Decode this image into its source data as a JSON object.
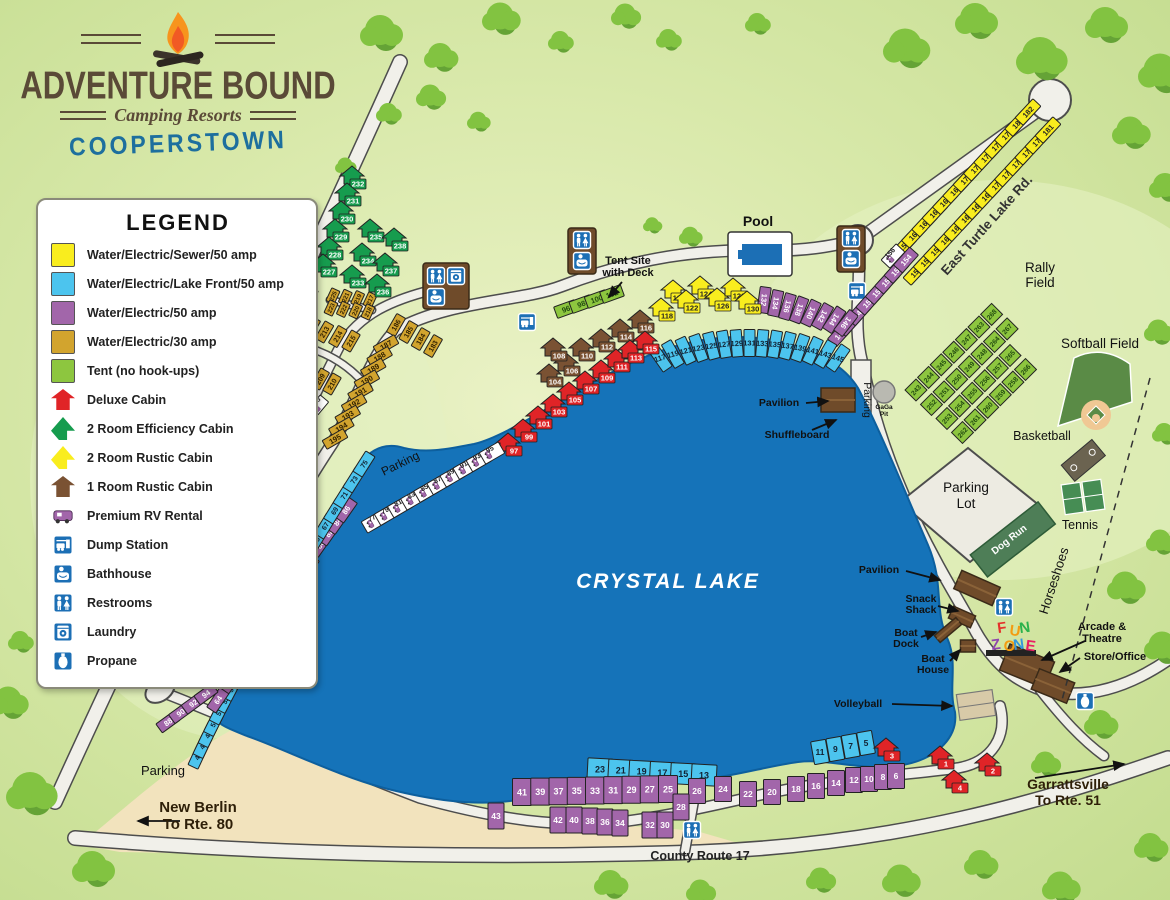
{
  "logo": {
    "name": "ADVENTURE BOUND",
    "tagline": "Camping Resorts",
    "location": "COOPERSTOWN"
  },
  "legend": {
    "title": "LEGEND",
    "items": [
      {
        "type": "yellow",
        "label": "Water/Electric/Sewer/50 amp"
      },
      {
        "type": "blue",
        "label": "Water/Electric/Lake Front/50 amp"
      },
      {
        "type": "purple",
        "label": "Water/Electric/50 amp"
      },
      {
        "type": "gold",
        "label": "Water/Electric/30 amp"
      },
      {
        "type": "tent",
        "label": "Tent (no hook-ups)"
      },
      {
        "type": "cabin-red",
        "label": "Deluxe Cabin"
      },
      {
        "type": "cabin-green",
        "label": "2 Room Efficiency Cabin"
      },
      {
        "type": "cabin-yellow",
        "label": "2 Room Rustic Cabin"
      },
      {
        "type": "cabin-brown",
        "label": "1 Room Rustic Cabin"
      },
      {
        "type": "rv",
        "label": "Premium RV Rental"
      },
      {
        "type": "dump",
        "label": "Dump Station"
      },
      {
        "type": "bath",
        "label": "Bathhouse"
      },
      {
        "type": "wc",
        "label": "Restrooms"
      },
      {
        "type": "laundry",
        "label": "Laundry"
      },
      {
        "type": "propane",
        "label": "Propane"
      }
    ]
  },
  "colors": {
    "yellow": "#f9ed1e",
    "blue": "#4cc4ee",
    "purple": "#a266aa",
    "gold": "#d2a42e",
    "tent": "#8dc63f",
    "cabin_red": "#e02427",
    "cabin_green": "#169c4e",
    "cabin_yellow": "#f9ed1e",
    "cabin_brown": "#7a5233",
    "rv_white": "#ffffff",
    "lake": "#1573b9",
    "road": "#f1f0ea",
    "icon_blue": "#1c6fb5",
    "beach": "#f2e3bd",
    "building": "#6f4b2a",
    "tree": "#82c341",
    "tree_dark": "#65a336"
  },
  "map": {
    "lake_name": "CRYSTAL LAKE",
    "labels": {
      "pool": "Pool",
      "tent_deck": [
        "Tent Site",
        "with Deck"
      ],
      "east_rd": "East Turtle Lake Rd.",
      "west_rd": "West Turtle Lake Rd.",
      "rally": [
        "Rally",
        "Field"
      ],
      "softball": "Softball Field",
      "basketball": "Basketball",
      "tennis": "Tennis",
      "horseshoes": "Horseshoes",
      "parking_lot": [
        "Parking",
        "Lot"
      ],
      "dog_run": "Dog Run",
      "gaga": [
        "GaGa",
        "Pit"
      ],
      "parking_sw": "Parking",
      "parking_w": "Parking",
      "parking_e": "Parking",
      "pavilion_n": "Pavilion",
      "shuffleboard": "Shuffleboard",
      "pavilion_s": "Pavilion",
      "snack": [
        "Snack",
        "Shack"
      ],
      "boat_dock": [
        "Boat",
        "Dock"
      ],
      "boat_house": [
        "Boat",
        "House"
      ],
      "volleyball": "Volleyball",
      "arcade": [
        "Arcade &",
        "Theatre"
      ],
      "store": "Store/Office",
      "county": "County Route 17",
      "new_berlin": [
        "New Berlin",
        "To Rte. 80"
      ],
      "garrattsville": [
        "Garrattsville",
        "To Rte. 51"
      ],
      "fun_zone": [
        "FUN",
        "ZONE"
      ]
    },
    "site_groups": [
      {
        "id": "ne_yellow_inner",
        "type": "yellow",
        "sites": [
          158,
          160,
          162,
          164,
          166,
          168,
          170,
          172,
          174,
          176,
          178,
          180,
          182
        ]
      },
      {
        "id": "ne_rv156",
        "type": "rv",
        "sites": [
          156
        ]
      },
      {
        "id": "ne_yellow_outer",
        "type": "yellow",
        "sites": [
          155,
          157,
          159,
          161,
          163,
          165,
          167,
          169,
          171,
          173,
          175,
          177,
          179,
          181
        ]
      },
      {
        "id": "ne_purple",
        "type": "purple",
        "sites": [
          147,
          148,
          149,
          150,
          151,
          152,
          153,
          154
        ]
      },
      {
        "id": "n_purple",
        "type": "purple",
        "sites": [
          132,
          134,
          136,
          138,
          140,
          142,
          144,
          146
        ]
      },
      {
        "id": "n_blue",
        "type": "blue",
        "sites": [
          117,
          119,
          121,
          123,
          125,
          127,
          129,
          131,
          133,
          135,
          137,
          139,
          141,
          143,
          145
        ]
      },
      {
        "id": "tent_deck_sites",
        "type": "tent",
        "sites": [
          96,
          98,
          100,
          102
        ]
      },
      {
        "id": "cabins_yellow",
        "type": "cabin-yellow",
        "sites": [
          118,
          120,
          122,
          124,
          126,
          128,
          130
        ]
      },
      {
        "id": "cabins_brown",
        "type": "cabin-brown",
        "sites": [
          104,
          106,
          108,
          110,
          112,
          114,
          116
        ]
      },
      {
        "id": "cabins_red_shore",
        "type": "cabin-red",
        "sites": [
          97,
          99,
          101,
          103,
          105,
          107,
          109,
          111,
          113,
          115
        ]
      },
      {
        "id": "rv_west",
        "type": "rv",
        "sites": [
          77,
          79,
          81,
          83,
          85,
          87,
          89,
          91,
          93,
          95
        ]
      },
      {
        "id": "w_purple_high",
        "type": "purple",
        "sites": [
          78,
          80,
          82,
          84,
          86
        ]
      },
      {
        "id": "w_blue",
        "type": "blue",
        "sites": [
          47,
          48,
          49,
          50,
          51,
          52,
          53,
          54,
          55,
          56,
          57,
          58,
          59,
          60,
          61,
          62,
          63,
          65,
          67,
          69,
          71,
          73,
          75
        ]
      },
      {
        "id": "w_purple_low",
        "type": "purple",
        "sites": [
          64,
          66,
          68,
          70,
          72,
          74,
          76
        ]
      },
      {
        "id": "sw_purple",
        "type": "purple",
        "sites": [
          88,
          90,
          92,
          94
        ]
      },
      {
        "id": "s_blue_left",
        "type": "blue",
        "sites": [
          23,
          21,
          19,
          17,
          15,
          13
        ]
      },
      {
        "id": "s_blue_right",
        "type": "blue",
        "sites": [
          11,
          9,
          7,
          5
        ]
      },
      {
        "id": "s_purple_top",
        "type": "purple",
        "sites": [
          41,
          39,
          37,
          35,
          33,
          31,
          29,
          27,
          25
        ]
      },
      {
        "id": "s_purple_right",
        "type": "purple",
        "sites": [
          26,
          24,
          22,
          20,
          18,
          16,
          14,
          12,
          10,
          8,
          6
        ]
      },
      {
        "id": "s_purple_low",
        "type": "purple",
        "sites": [
          43,
          42,
          40,
          38,
          36,
          34,
          32,
          30,
          28
        ]
      },
      {
        "id": "s_cabins_red",
        "type": "cabin-red",
        "sites": [
          3,
          1,
          2,
          4
        ]
      },
      {
        "id": "g_183",
        "type": "gold",
        "sites": [
          186,
          185,
          184,
          183
        ]
      },
      {
        "id": "g_187",
        "type": "gold",
        "sites": [
          187,
          188,
          189,
          190,
          191,
          192,
          193,
          194,
          195
        ]
      },
      {
        "id": "g_196",
        "type": "gold",
        "sites": [
          196,
          197,
          198,
          199,
          200
        ]
      },
      {
        "id": "g_201",
        "type": "gold",
        "sites": [
          201,
          202
        ]
      },
      {
        "id": "g_rv203",
        "type": "rv",
        "sites": [
          203,
          204,
          205
        ]
      },
      {
        "id": "g_206",
        "type": "gold",
        "sites": [
          206,
          207,
          208,
          209,
          210
        ]
      },
      {
        "id": "g_211",
        "type": "gold",
        "sites": [
          211,
          212,
          213,
          214,
          215
        ]
      },
      {
        "id": "g_217a",
        "type": "gold",
        "sites": [
          225,
          221,
          219,
          217
        ]
      },
      {
        "id": "g_217b",
        "type": "gold",
        "sites": [
          223,
          222,
          220,
          218
        ]
      },
      {
        "id": "g_224",
        "type": "gold",
        "sites": [
          224
        ]
      },
      {
        "id": "cabins_green_col",
        "type": "cabin-green",
        "sites": [
          232,
          231,
          230,
          229,
          228,
          227
        ]
      },
      {
        "id": "cabins_green_cluster",
        "type": "cabin-green",
        "sites": [
          235,
          238,
          234,
          237,
          233,
          236
        ]
      },
      {
        "id": "tent_241",
        "type": "tent",
        "sites": [
          242,
          241
        ]
      },
      {
        "id": "rally",
        "type": "tent",
        "grid_cols": [
          [
            243,
            244,
            245,
            246,
            247,
            263,
            268
          ],
          [
            252,
            251,
            250,
            249,
            248,
            264,
            267
          ],
          [
            253,
            254,
            255,
            256,
            257,
            265
          ],
          [
            262,
            261,
            260,
            259,
            258,
            266
          ]
        ],
        "sites": []
      }
    ]
  }
}
